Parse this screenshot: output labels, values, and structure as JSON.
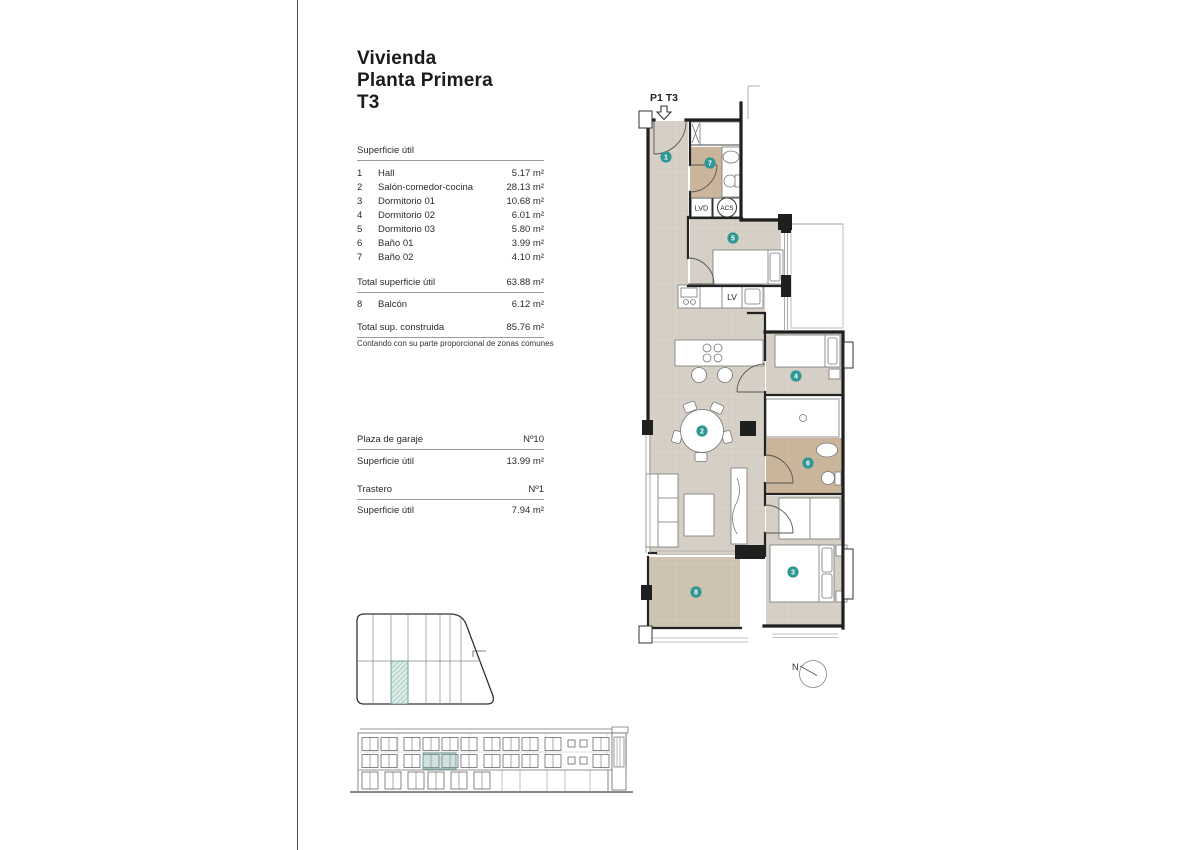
{
  "header": {
    "title_line1": "Vivienda",
    "title_line2": "Planta Primera",
    "title_line3": "T3"
  },
  "surface_table": {
    "section_title": "Superficie útil",
    "rows": [
      {
        "num": "1",
        "label": "Hall",
        "value": "5.17 m²"
      },
      {
        "num": "2",
        "label": "Salón-comedor-cocina",
        "value": "28.13 m²"
      },
      {
        "num": "3",
        "label": "Dormitorio 01",
        "value": "10.68 m²"
      },
      {
        "num": "4",
        "label": "Dormitorio 02",
        "value": "6.01 m²"
      },
      {
        "num": "5",
        "label": "Dormitorio 03",
        "value": "5.80 m²"
      },
      {
        "num": "6",
        "label": "Baño 01",
        "value": "3.99 m²"
      },
      {
        "num": "7",
        "label": "Baño 02",
        "value": "4.10 m²"
      }
    ],
    "total_util": {
      "label": "Total superficie útil",
      "value": "63.88 m²"
    },
    "balcony_row": {
      "num": "8",
      "label": "Balcón",
      "value": "6.12 m²"
    },
    "total_built": {
      "label": "Total sup. construida",
      "value": "85.76 m²"
    },
    "footnote": "Contando con su parte proporcional de zonas comunes"
  },
  "garage": {
    "title": "Plaza de garaje",
    "number": "Nº10",
    "row_label": "Superficie útil",
    "row_value": "13.99 m²"
  },
  "storage": {
    "title": "Trastero",
    "number": "Nº1",
    "row_label": "Superficie útil",
    "row_value": "7.94 m²"
  },
  "floorplan": {
    "unit_label": "P1 T3",
    "north_label": "N",
    "room_markers": [
      "1",
      "2",
      "3",
      "4",
      "5",
      "6",
      "7",
      "8"
    ],
    "fixture_labels": {
      "lvd": "LVD",
      "acs": "ACS",
      "lv": "LV"
    }
  },
  "colors": {
    "floor_beige": "#d7d0c6",
    "bath_tan": "#cbb69c",
    "balcony_tan": "#cfc3b2",
    "marker_teal": "#2f9894",
    "highlight_teal": "#dcebe8"
  }
}
